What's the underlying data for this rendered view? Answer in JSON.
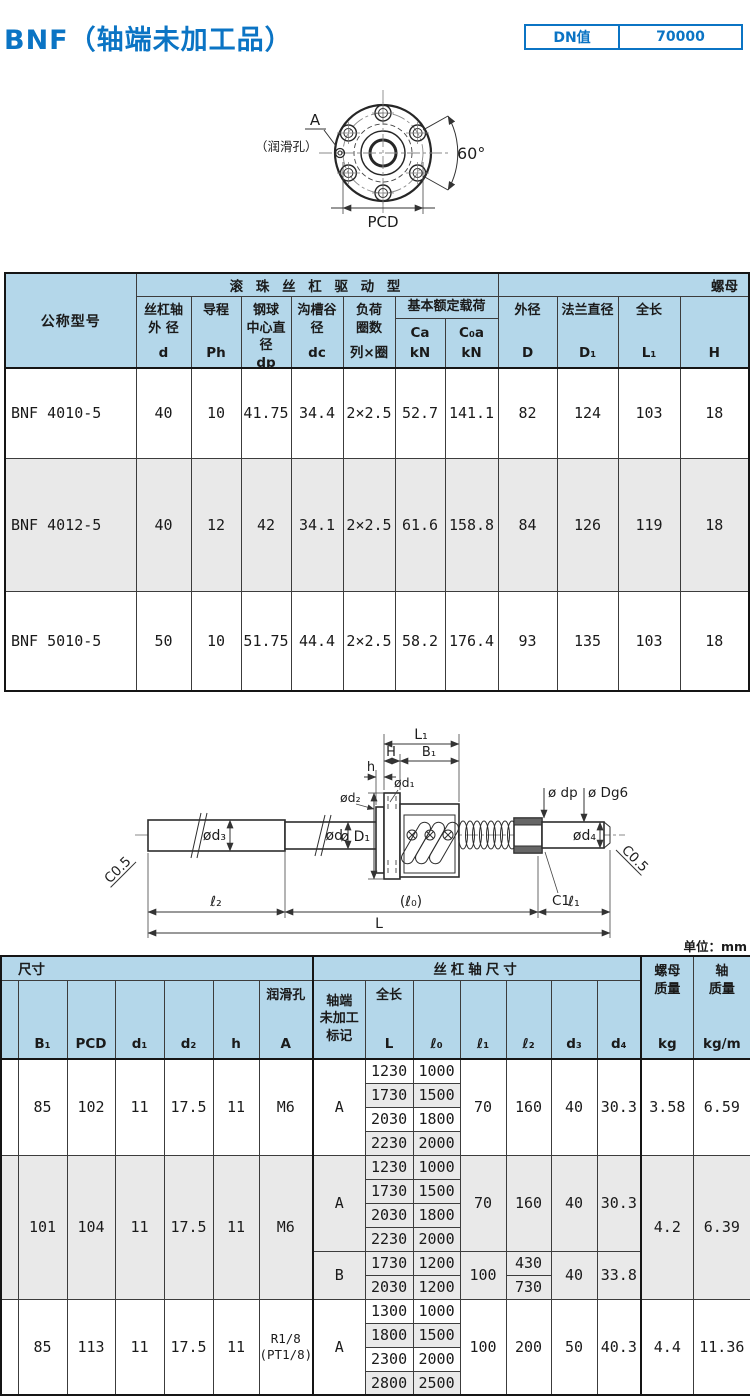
{
  "page": {
    "title": "BNF（轴端未加工品）",
    "unit_note": "单位：mm"
  },
  "dn": {
    "label": "DN值",
    "value": "70000"
  },
  "flange_view": {
    "label_a": "A",
    "label_lube": "（润滑孔）",
    "label_angle": "60°",
    "label_pcd": "PCD"
  },
  "drawing": {
    "L1": "L₁",
    "H": "H",
    "B1": "B₁",
    "h": "h",
    "d1": "ød₁",
    "d2": "ød₂",
    "dp": "ø dp",
    "dg6": "ø Dg6",
    "d3": "ød₃",
    "d": "ød",
    "D1": "ø D₁",
    "d4": "ød₄",
    "c1": "C1",
    "c05_left": "C0.5",
    "c05_right": "C0.5",
    "l2": "ℓ₂",
    "l0": "(ℓ₀)",
    "l1": "ℓ₁",
    "L": "L"
  },
  "table1": {
    "model_header": "公称型号",
    "drive_header": "滚 珠 丝 杠 驱 动 型",
    "nut_header": "螺母",
    "cols": [
      {
        "label": "丝杠轴\n外 径",
        "sym": "d"
      },
      {
        "label": "导程",
        "sym": "Ph"
      },
      {
        "label": "钢球\n中心直径",
        "sym": "dp"
      },
      {
        "label": "沟槽谷径",
        "sym": "dc"
      },
      {
        "label": "负荷\n圈数",
        "sym": "列×圈"
      }
    ],
    "load": {
      "header": "基本额定载荷",
      "cols": [
        {
          "sym": "Ca",
          "unit": "kN"
        },
        {
          "sym": "C₀a",
          "unit": "kN"
        }
      ]
    },
    "nut_cols": [
      {
        "label": "外径",
        "sym": "D"
      },
      {
        "label": "法兰直径",
        "sym": "D₁"
      },
      {
        "label": "全长",
        "sym": "L₁"
      },
      {
        "label": "",
        "sym": "H"
      }
    ],
    "rows": [
      {
        "model": "BNF 4010-5",
        "values": [
          "40",
          "10",
          "41.75",
          "34.4",
          "2×2.5",
          "52.7",
          "141.1",
          "82",
          "124",
          "103",
          "18"
        ]
      },
      {
        "model": "BNF 4012-5",
        "values": [
          "40",
          "12",
          "42",
          "34.1",
          "2×2.5",
          "61.6",
          "158.8",
          "84",
          "126",
          "119",
          "18"
        ]
      },
      {
        "model": "BNF 5010-5",
        "values": [
          "50",
          "10",
          "51.75",
          "44.4",
          "2×2.5",
          "58.2",
          "176.4",
          "93",
          "135",
          "103",
          "18"
        ]
      }
    ]
  },
  "table2": {
    "size_header": "尺寸",
    "shaft_header": "丝杠轴尺寸",
    "cols": {
      "B1": "B₁",
      "PCD": "PCD",
      "d1": "d₁",
      "d2": "d₂",
      "h": "h",
      "lube_label": "润滑孔",
      "lube_sym": "A",
      "mark_label": "轴端\n未加工\n标记",
      "length_label": "全长",
      "length_sym": "L",
      "l0": "ℓ₀",
      "l1": "ℓ₁",
      "l2": "ℓ₂",
      "d3": "d₃",
      "d4": "d₄",
      "nut_mass_label": "螺母\n质量",
      "nut_mass_unit": "kg",
      "shaft_mass_label": "轴\n质量",
      "shaft_mass_unit": "kg/m"
    },
    "groups": [
      {
        "b1": "85",
        "pcd": "102",
        "d1": "11",
        "d2": "17.5",
        "h": "11",
        "lube": "M6",
        "nut_mass": "3.58",
        "shaft_mass": "6.59",
        "blocks": [
          {
            "mark": "A",
            "l1": "70",
            "l2": [
              "160"
            ],
            "d3": "40",
            "d4": "30.3",
            "pairs": [
              [
                "1230",
                "1000"
              ],
              [
                "1730",
                "1500"
              ],
              [
                "2030",
                "1800"
              ],
              [
                "2230",
                "2000"
              ]
            ]
          }
        ]
      },
      {
        "b1": "101",
        "pcd": "104",
        "d1": "11",
        "d2": "17.5",
        "h": "11",
        "lube": "M6",
        "nut_mass": "4.2",
        "shaft_mass": "6.39",
        "blocks": [
          {
            "mark": "A",
            "l1": "70",
            "l2": [
              "160"
            ],
            "d3": "40",
            "d4": "30.3",
            "pairs": [
              [
                "1230",
                "1000"
              ],
              [
                "1730",
                "1500"
              ],
              [
                "2030",
                "1800"
              ],
              [
                "2230",
                "2000"
              ]
            ]
          },
          {
            "mark": "B",
            "l1": "100",
            "l2": [
              "430",
              "730"
            ],
            "d3": "40",
            "d4": "33.8",
            "pairs": [
              [
                "1730",
                "1200"
              ],
              [
                "2030",
                "1200"
              ]
            ]
          }
        ]
      },
      {
        "b1": "85",
        "pcd": "113",
        "d1": "11",
        "d2": "17.5",
        "h": "11",
        "lube": "R1/8\n(PT1/8)",
        "nut_mass": "4.4",
        "shaft_mass": "11.36",
        "blocks": [
          {
            "mark": "A",
            "l1": "100",
            "l2": [
              "200"
            ],
            "d3": "50",
            "d4": "40.3",
            "pairs": [
              [
                "1300",
                "1000"
              ],
              [
                "1800",
                "1500"
              ],
              [
                "2300",
                "2000"
              ],
              [
                "2800",
                "2500"
              ]
            ]
          }
        ]
      }
    ]
  }
}
